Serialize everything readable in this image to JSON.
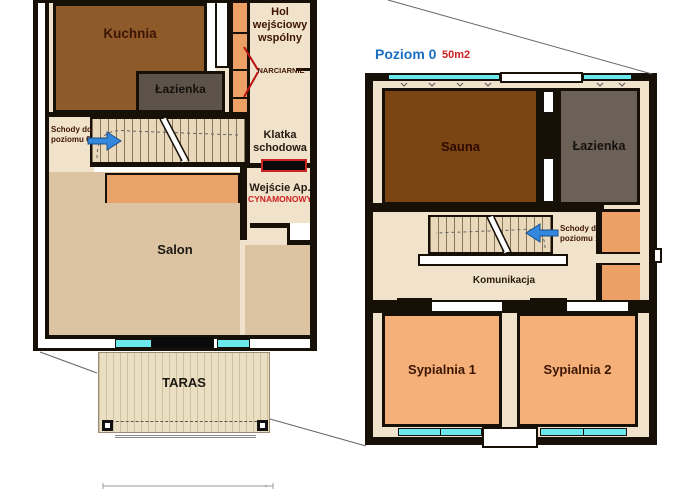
{
  "colors": {
    "room_brown": "#8f5a2a",
    "sauna_brown": "#7a4513",
    "bathroom_gray_left": "#5d5349",
    "bathroom_gray_right": "#6c6156",
    "beige": "#f1e2cb",
    "salon_tan": "#dcc3a2",
    "bedroom_orange": "#f4b078",
    "closet_orange": "#eca066",
    "feature_orange": "#e8a36a",
    "window_cyan": "#6ae8ec",
    "accent_red": "#cc2222",
    "accent_blue": "#1b6ec2",
    "label_maroon": "#3d1505",
    "wall_black": "#171007",
    "taras_wood": "#ebdfc2"
  },
  "left_plan": {
    "rooms": {
      "kuchnia": {
        "label": "Kuchnia"
      },
      "lazienka": {
        "label": "Łazienka"
      },
      "hol": {
        "line1": "Hol",
        "line2": "wejściowy",
        "line3": "wspólny"
      },
      "narciarnie": {
        "label": "NARCIARNIE"
      },
      "schody": {
        "line1": "Schody do",
        "line2": "poziomu 0"
      },
      "klatka": {
        "line1": "Klatka",
        "line2": "schodowa"
      },
      "wejscie": {
        "line1": "Wejście Ap.",
        "line2": "CYNAMONOWY"
      },
      "salon": {
        "label": "Salon"
      },
      "taras": {
        "label": "TARAS"
      }
    }
  },
  "right_plan": {
    "header": {
      "level": "Poziom 0",
      "area": "50m2"
    },
    "rooms": {
      "sauna": {
        "label": "Sauna"
      },
      "lazienka": {
        "label": "Łazienka"
      },
      "schody": {
        "line1": "Schody do",
        "line2": "poziomu 1"
      },
      "komunikacja": {
        "label": "Komunikacja"
      },
      "sypialnia1": {
        "label": "Sypialnia 1"
      },
      "sypialnia2": {
        "label": "Sypialnia 2"
      }
    }
  }
}
